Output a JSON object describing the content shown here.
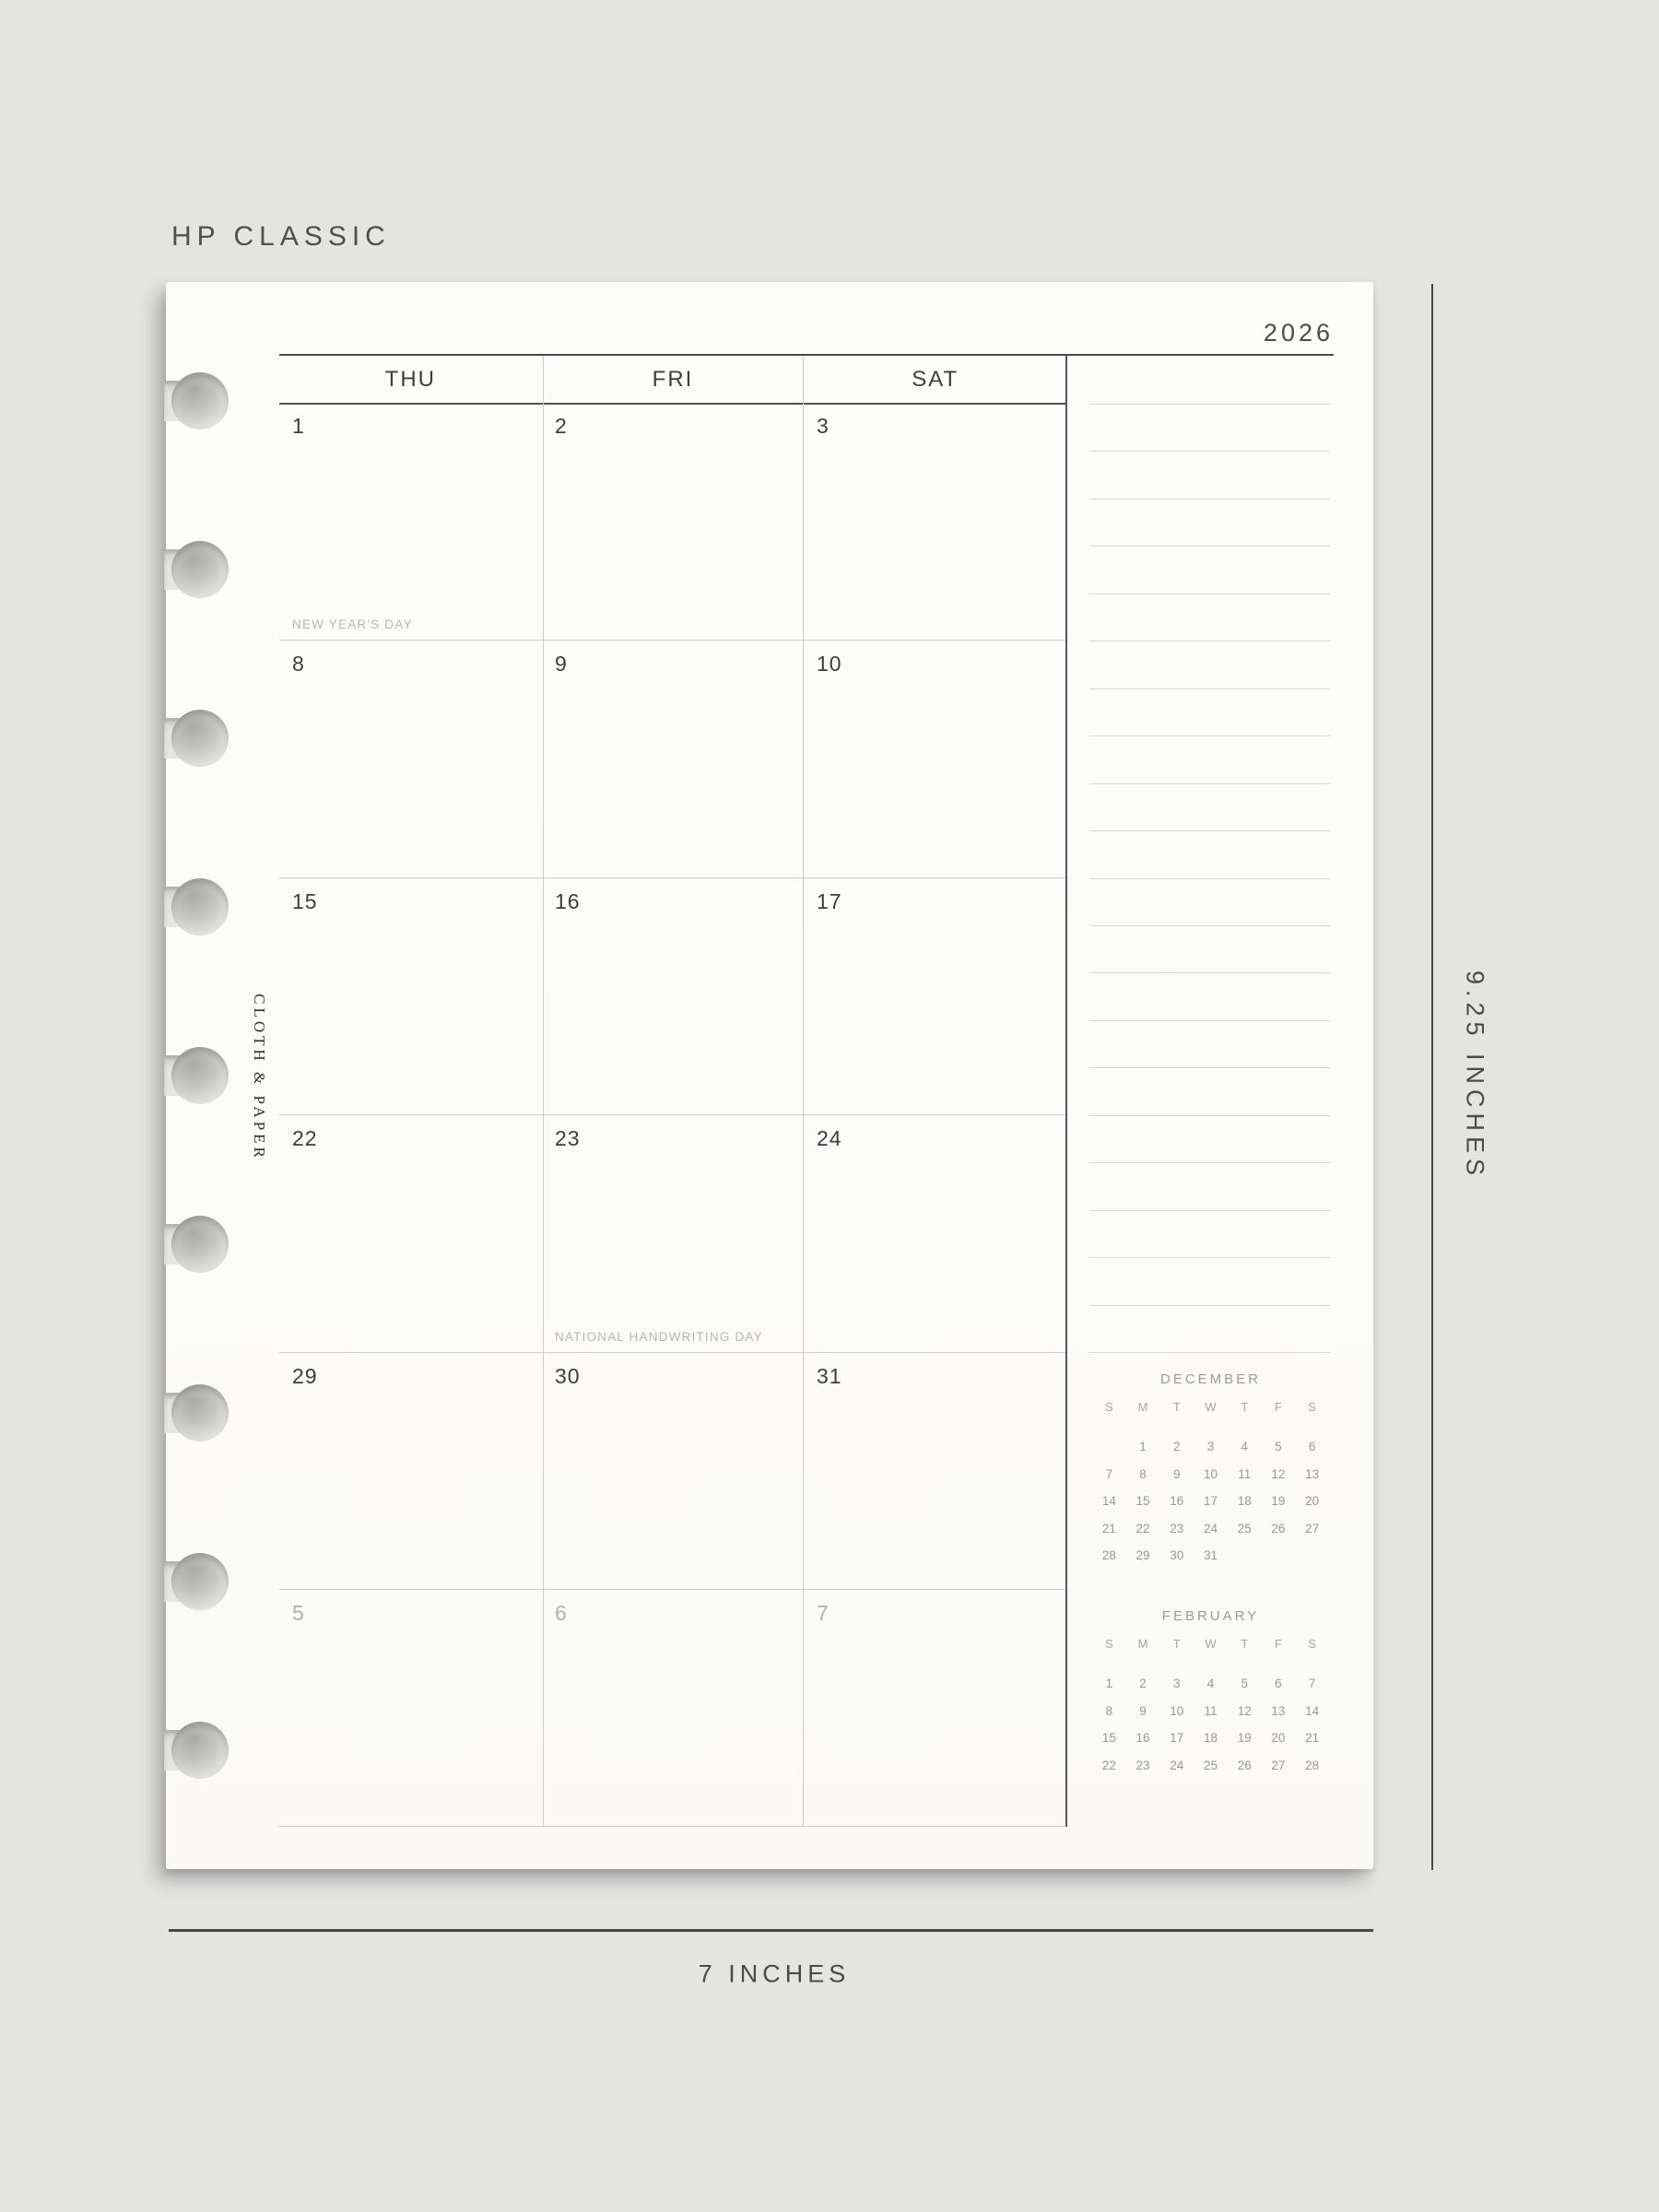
{
  "header": {
    "size_label": "HP CLASSIC",
    "year": "2026"
  },
  "brand": {
    "logo_text": "CLOTH & PAPER"
  },
  "measurements": {
    "width_label": "7 INCHES",
    "height_label": "9.25 INCHES"
  },
  "calendar": {
    "day_headers": [
      "THU",
      "FRI",
      "SAT"
    ],
    "weeks": [
      [
        {
          "date": "1",
          "note": "NEW YEAR'S DAY"
        },
        {
          "date": "2",
          "note": ""
        },
        {
          "date": "3",
          "note": ""
        }
      ],
      [
        {
          "date": "8",
          "note": ""
        },
        {
          "date": "9",
          "note": ""
        },
        {
          "date": "10",
          "note": ""
        }
      ],
      [
        {
          "date": "15",
          "note": ""
        },
        {
          "date": "16",
          "note": ""
        },
        {
          "date": "17",
          "note": ""
        }
      ],
      [
        {
          "date": "22",
          "note": ""
        },
        {
          "date": "23",
          "note": "NATIONAL HANDWRITING DAY"
        },
        {
          "date": "24",
          "note": ""
        }
      ],
      [
        {
          "date": "29",
          "note": ""
        },
        {
          "date": "30",
          "note": ""
        },
        {
          "date": "31",
          "note": ""
        }
      ],
      [
        {
          "date": "5",
          "note": ""
        },
        {
          "date": "6",
          "note": ""
        },
        {
          "date": "7",
          "note": ""
        }
      ]
    ]
  },
  "notes_panel": {
    "line_count": 21
  },
  "mini_calendars": [
    {
      "title": "DECEMBER",
      "day_letters": [
        "S",
        "M",
        "T",
        "W",
        "T",
        "F",
        "S"
      ],
      "weeks": [
        [
          "",
          "1",
          "2",
          "3",
          "4",
          "5",
          "6"
        ],
        [
          "7",
          "8",
          "9",
          "10",
          "11",
          "12",
          "13"
        ],
        [
          "14",
          "15",
          "16",
          "17",
          "18",
          "19",
          "20"
        ],
        [
          "21",
          "22",
          "23",
          "24",
          "25",
          "26",
          "27"
        ],
        [
          "28",
          "29",
          "30",
          "31",
          "",
          "",
          ""
        ]
      ]
    },
    {
      "title": "FEBRUARY",
      "day_letters": [
        "S",
        "M",
        "T",
        "W",
        "T",
        "F",
        "S"
      ],
      "weeks": [
        [
          "1",
          "2",
          "3",
          "4",
          "5",
          "6",
          "7"
        ],
        [
          "8",
          "9",
          "10",
          "11",
          "12",
          "13",
          "14"
        ],
        [
          "15",
          "16",
          "17",
          "18",
          "19",
          "20",
          "21"
        ],
        [
          "22",
          "23",
          "24",
          "25",
          "26",
          "27",
          "28"
        ]
      ]
    }
  ],
  "colors": {
    "background": "#e4e4e3",
    "paper": "#fbfbf9",
    "ink_dark": "#4a4a4a",
    "grid_light": "#cccccb",
    "note_line": "#d7d7d5",
    "muted_text": "#b0b0af",
    "holiday_text": "#b6b6b4",
    "mini_cal_text": "#9b9b9b"
  }
}
